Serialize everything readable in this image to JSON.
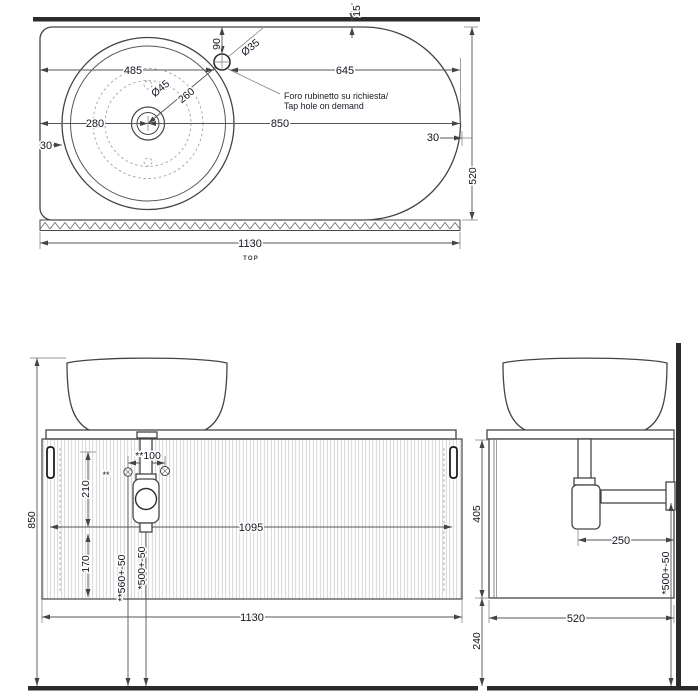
{
  "meta": {
    "view_label": "TOP"
  },
  "note": {
    "line1": "Foro rubinetto su richiesta/",
    "line2": "Tap hole on demand"
  },
  "top_view": {
    "wall_offset": "15",
    "tap_left": "485",
    "tap_right": "645",
    "tap_depth": "90",
    "tap_dia": "Ø35",
    "drain_dia": "Ø45",
    "drain_to_tap": "260",
    "basin_left": "280",
    "basin_right": "850",
    "edge_left": "30",
    "edge_right": "30",
    "depth": "520",
    "width": "1130"
  },
  "front_view": {
    "height": "850",
    "upper": "210",
    "lower": "170",
    "supply_span": "**100",
    "footnote": "**",
    "supply_height": "**560+-50",
    "drain_height": "*500+-50",
    "inner_width": "1095",
    "width": "1130"
  },
  "side_view": {
    "body_height": "405",
    "floor_clearance": "240",
    "trap_to_wall": "250",
    "drain_height": "*500+-50",
    "depth": "520"
  },
  "colors": {
    "line": "#454545",
    "dim": "#555555",
    "heavy": "#2b2b2b",
    "text": "#14141f"
  }
}
